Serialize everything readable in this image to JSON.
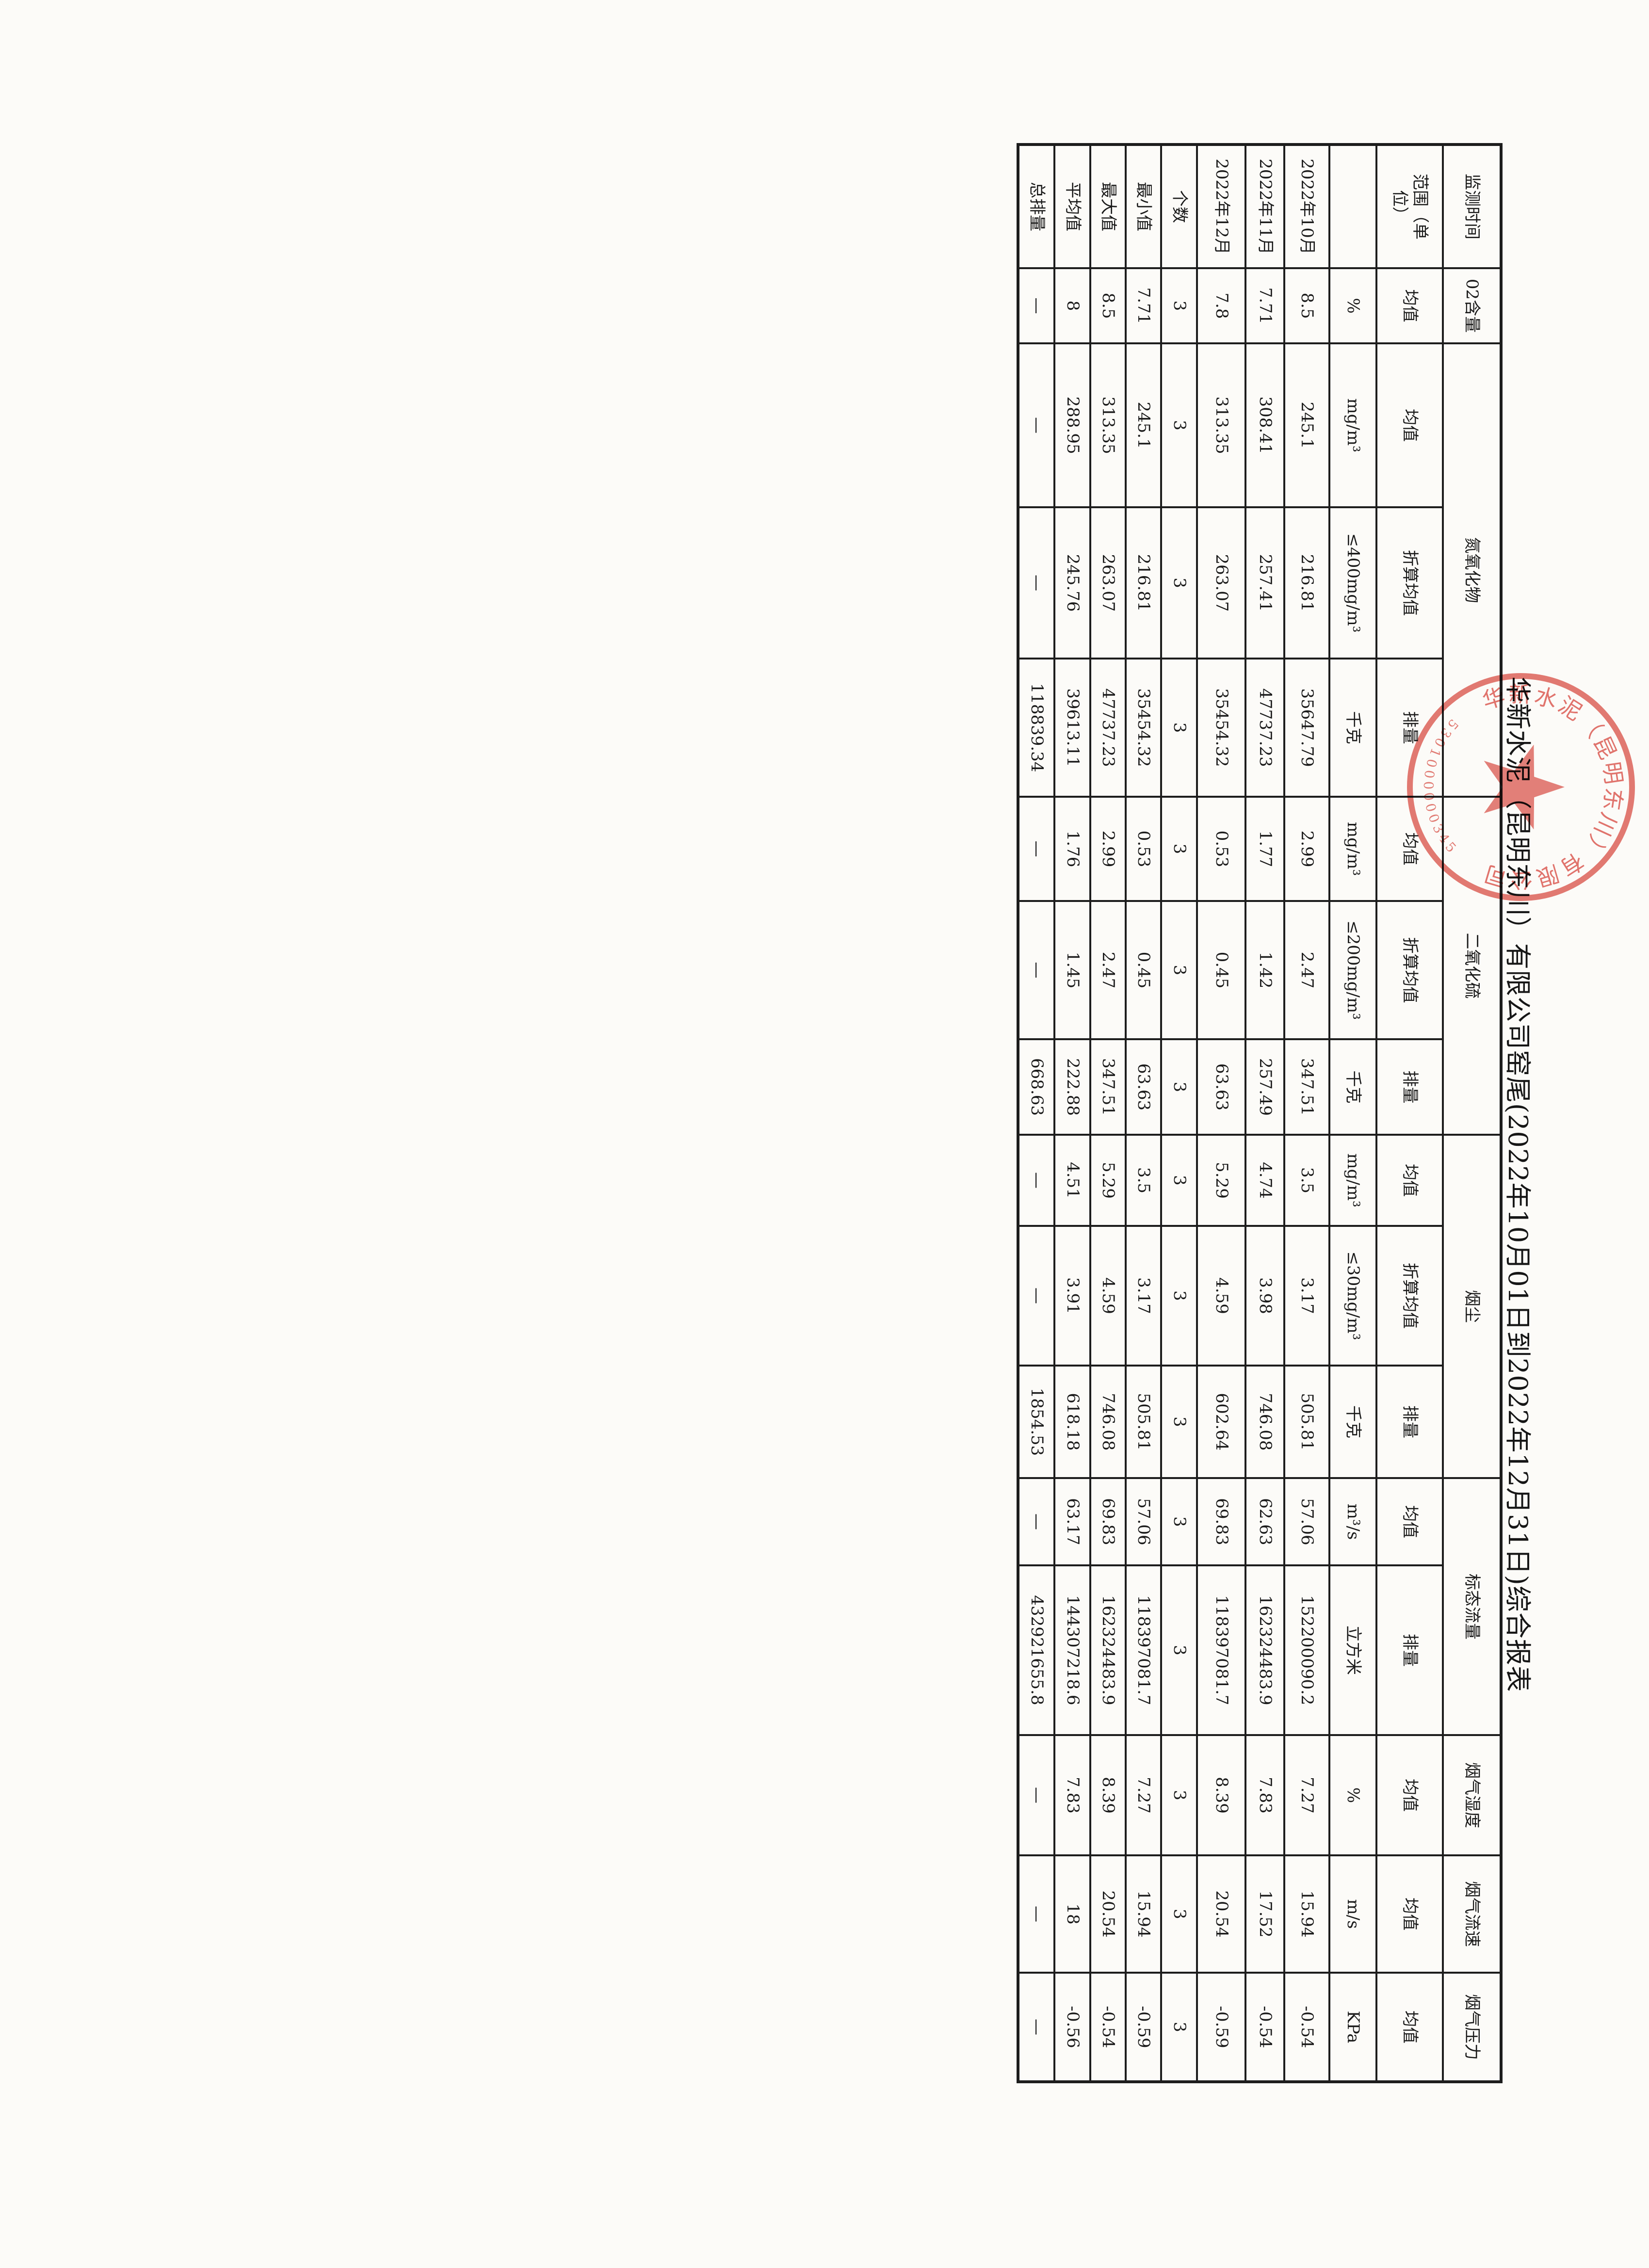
{
  "title": "华新水泥（昆明东川）有限公司窑尾(2022年10月01日到2022年12月31日)综合报表",
  "stamp": {
    "company_arc_text": "华新水泥（昆明东川）有限公司",
    "serial_arc_text": "5301000000345",
    "star_icon": "red-star",
    "color": "#d6453c"
  },
  "table": {
    "header": {
      "row1": [
        {
          "label": "监测时间",
          "colspan": 1
        },
        {
          "label": "02含量",
          "colspan": 1
        },
        {
          "label": "氮氧化物",
          "colspan": 3
        },
        {
          "label": "二氧化硫",
          "colspan": 3
        },
        {
          "label": "烟尘",
          "colspan": 3
        },
        {
          "label": "标态流量",
          "colspan": 2
        },
        {
          "label": "烟气湿度",
          "colspan": 1
        },
        {
          "label": "烟气流速",
          "colspan": 1
        },
        {
          "label": "烟气压力",
          "colspan": 1
        }
      ],
      "row2": [
        "范围（单位）",
        "均值",
        "均值",
        "折算均值",
        "排量",
        "均值",
        "折算均值",
        "排量",
        "均值",
        "折算均值",
        "排量",
        "均值",
        "排量",
        "均值",
        "均值",
        "均值"
      ],
      "row3": [
        "",
        "%",
        "mg/m³",
        "≤400mg/m³",
        "千克",
        "mg/m³",
        "≤200mg/m³",
        "千克",
        "mg/m³",
        "≤30mg/m³",
        "千克",
        "m³/s",
        "立方米",
        "%",
        "m/s",
        "KPa"
      ]
    },
    "body": [
      {
        "label": "2022年10月",
        "values": [
          "8.5",
          "245.1",
          "216.81",
          "35647.79",
          "2.99",
          "2.47",
          "347.51",
          "3.5",
          "3.17",
          "505.81",
          "57.06",
          "152200090.2",
          "7.27",
          "15.94",
          "-0.54"
        ]
      },
      {
        "label": "2022年11月",
        "values": [
          "7.71",
          "308.41",
          "257.41",
          "47737.23",
          "1.77",
          "1.42",
          "257.49",
          "4.74",
          "3.98",
          "746.08",
          "62.63",
          "162324483.9",
          "7.83",
          "17.52",
          "-0.54"
        ]
      },
      {
        "label": "2022年12月",
        "values": [
          "7.8",
          "313.35",
          "263.07",
          "35454.32",
          "0.53",
          "0.45",
          "63.63",
          "5.29",
          "4.59",
          "602.64",
          "69.83",
          "118397081.7",
          "8.39",
          "20.54",
          "-0.59"
        ]
      },
      {
        "label": "个数",
        "values": [
          "3",
          "3",
          "3",
          "3",
          "3",
          "3",
          "3",
          "3",
          "3",
          "3",
          "3",
          "3",
          "3",
          "3",
          "3"
        ]
      },
      {
        "label": "最小值",
        "values": [
          "7.71",
          "245.1",
          "216.81",
          "35454.32",
          "0.53",
          "0.45",
          "63.63",
          "3.5",
          "3.17",
          "505.81",
          "57.06",
          "118397081.7",
          "7.27",
          "15.94",
          "-0.59"
        ]
      },
      {
        "label": "最大值",
        "values": [
          "8.5",
          "313.35",
          "263.07",
          "47737.23",
          "2.99",
          "2.47",
          "347.51",
          "5.29",
          "4.59",
          "746.08",
          "69.83",
          "162324483.9",
          "8.39",
          "20.54",
          "-0.54"
        ]
      },
      {
        "label": "平均值",
        "values": [
          "8",
          "288.95",
          "245.76",
          "39613.11",
          "1.76",
          "1.45",
          "222.88",
          "4.51",
          "3.91",
          "618.18",
          "63.17",
          "144307218.6",
          "7.83",
          "18",
          "-0.56"
        ]
      },
      {
        "label": "总排量",
        "values": [
          "—",
          "—",
          "—",
          "118839.34",
          "—",
          "—",
          "668.63",
          "—",
          "—",
          "1854.53",
          "—",
          "432921655.8",
          "—",
          "—",
          "—"
        ]
      }
    ]
  }
}
